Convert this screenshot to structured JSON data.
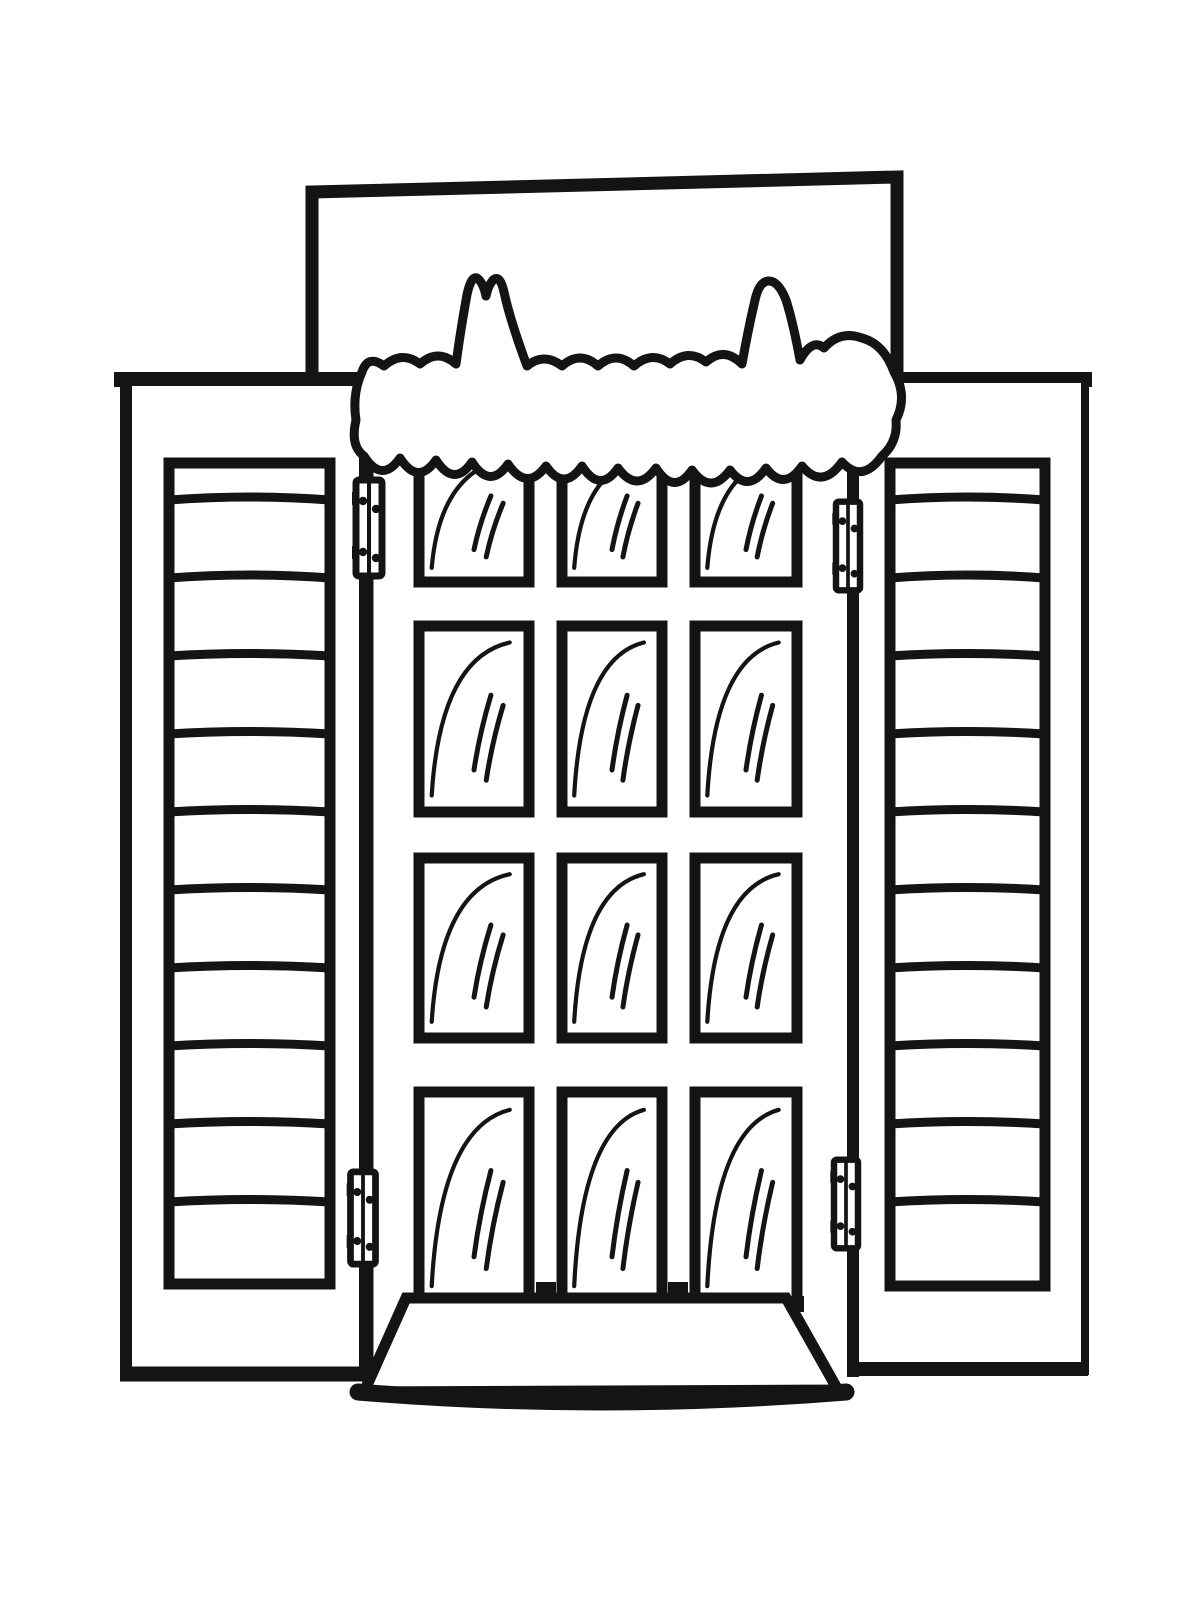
{
  "page": {
    "title": "Snow-topped window with open shutters — coloring page",
    "background_color": "#ffffff",
    "ink_color": "#141414"
  },
  "scene": {
    "description": "Black and white line-art coloring page of a closed 12-pane window flanked by two open louvered shutters, a drift of snow with two tall peaks piled along the top ledge, four hinges, and a flared window sill below.",
    "wall_ledge": {
      "label": "wall panel above window"
    },
    "snow": {
      "label": "snow drift",
      "peak_count": 2
    },
    "window": {
      "label": "window",
      "pane_columns": 3,
      "pane_rows": 4,
      "pane_count": 12
    },
    "left_shutter": {
      "label": "left shutter",
      "slat_count": 11
    },
    "right_shutter": {
      "label": "right shutter",
      "slat_count": 11
    },
    "hinges": {
      "label": "hinges",
      "count": 4
    },
    "sill": {
      "label": "window sill"
    }
  }
}
